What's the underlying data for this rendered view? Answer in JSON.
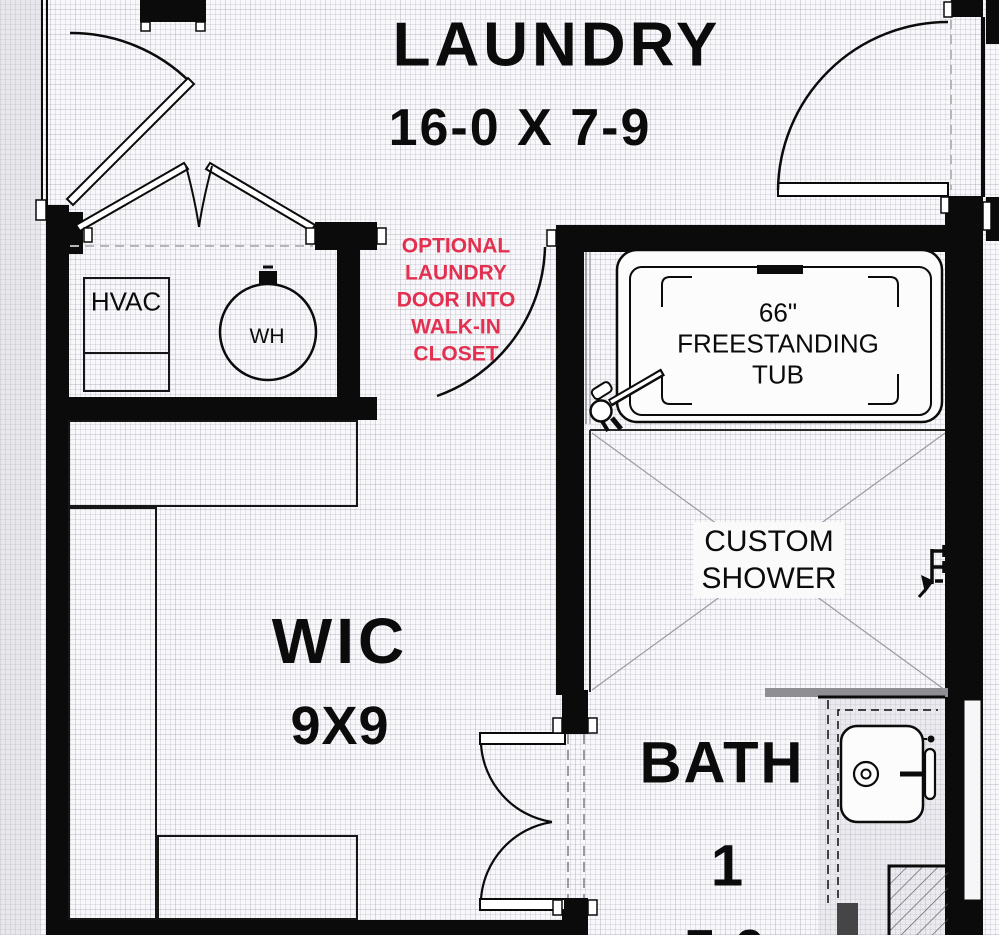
{
  "drawing": {
    "type": "residential-floor-plan",
    "rooms": {
      "laundry": {
        "name": "LAUNDRY",
        "dims": "16-0 X 7-9"
      },
      "wic": {
        "name": "WIC",
        "dims": "9X9"
      },
      "bath": {
        "name": "BATH",
        "number": "1",
        "dims_partial": "7-9"
      }
    },
    "note": {
      "lines": [
        "OPTIONAL",
        "LAUNDRY",
        "DOOR INTO",
        "WALK-IN",
        "CLOSET"
      ],
      "color": "#e33050"
    },
    "fixtures": {
      "hvac": "HVAC",
      "water_heater": "WH",
      "tub_lines": [
        "66\"",
        "FREESTANDING",
        "TUB"
      ],
      "shower_lines": [
        "CUSTOM",
        "SHOWER"
      ]
    },
    "colors": {
      "wall": "#0b0b0b",
      "note_red": "#e33050",
      "floor_grid_bg": "#f8f8fa",
      "outside_strip": "#e8e8ec",
      "shower_screen_gray": "#8f8f93"
    }
  }
}
